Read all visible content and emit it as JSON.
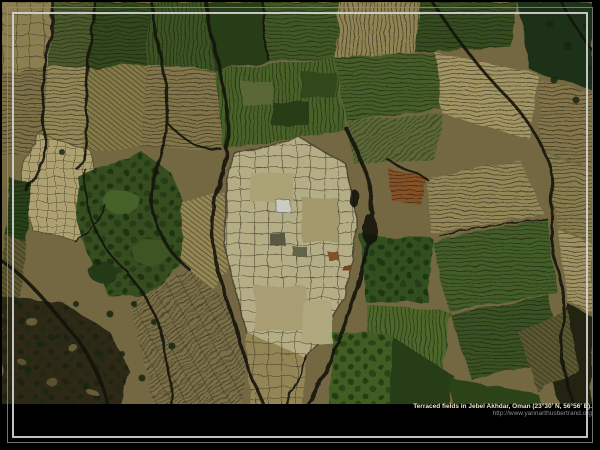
{
  "wallpaper": {
    "caption": "Terraced fields in Jebel Akhdar, Oman (23°30' N, 56°56' E).",
    "credit_url": "http://www.yannarthusbertrand.org",
    "subject": "aerial-photo-terraced-fields"
  },
  "palette": {
    "background": "#000000",
    "frame_outer": "#8a8a8a",
    "frame_inner": "#d6d6d6",
    "caption_text": "#efe9c2",
    "url_text": "#8c8c8c",
    "field_tan": "#ab9c65",
    "field_green": "#4e6b2f",
    "terrace_cream": "#d8cfa0",
    "wadi_dark": "#15130c"
  }
}
